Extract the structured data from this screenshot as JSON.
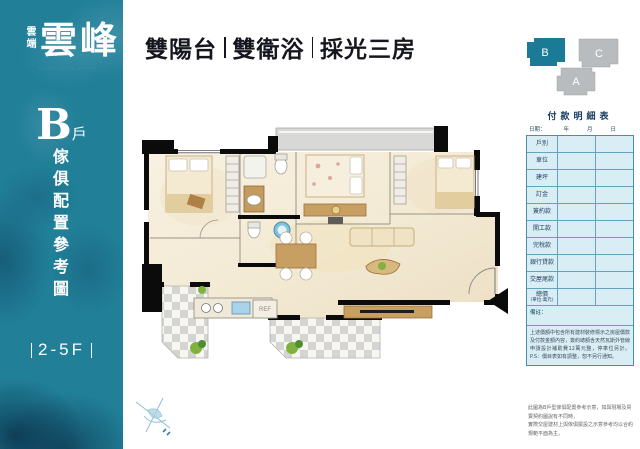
{
  "brand": {
    "prefix": "雲端",
    "name": "雲峰",
    "tagline": "····· ····· ·····"
  },
  "sidebar": {
    "unit_letter": "B",
    "unit_suffix": "戶",
    "vertical_title": "傢俱配置參考圖",
    "floors": "2-5F"
  },
  "header": {
    "features": [
      "雙陽台",
      "雙衛浴",
      "採光三房"
    ]
  },
  "keyplan": {
    "units": [
      {
        "label": "B",
        "state": "highlighted",
        "color": "#1b7b97"
      },
      {
        "label": "C",
        "state": "normal",
        "color": "#b9bcbe"
      },
      {
        "label": "A",
        "state": "normal",
        "color": "#b9bcbe"
      }
    ]
  },
  "floorplan": {
    "ref_label": "REF"
  },
  "payment_table": {
    "title": "付款明細表",
    "date_label": "日期：",
    "date_units": [
      "年",
      "月",
      "日"
    ],
    "rows": [
      "戶別",
      "車位",
      "建坪",
      "訂金",
      "簽約款",
      "開工款",
      "完稅款",
      "銀行貸款",
      "交屋尾款"
    ],
    "total_row": {
      "line1": "總價",
      "line2": "(單位:萬元)"
    },
    "notes_label": "備註：",
    "fine_print": "上述價額中包含所有建材裝修標示之房屋價款及付款金額內容，簽約總額含天然瓦斯外管線申請設計補助費12萬元整，停車位另計。P.S：價目表如有調整，恕不另行通知。"
  },
  "footnote": {
    "line1": "此圖為B戶型傢俱配置參考示意，如與現場及買賣契約圖說有不同時，",
    "line2": "實際交屋建材上與傢俱擺設之示意參考均以合約規範平面為主。"
  },
  "colors": {
    "sidebar_teal": "#217f98",
    "keyplan_highlight": "#1b7b97",
    "table_border": "#4190b0",
    "table_bg": "#d9edf5",
    "header_text": "#16161f"
  }
}
